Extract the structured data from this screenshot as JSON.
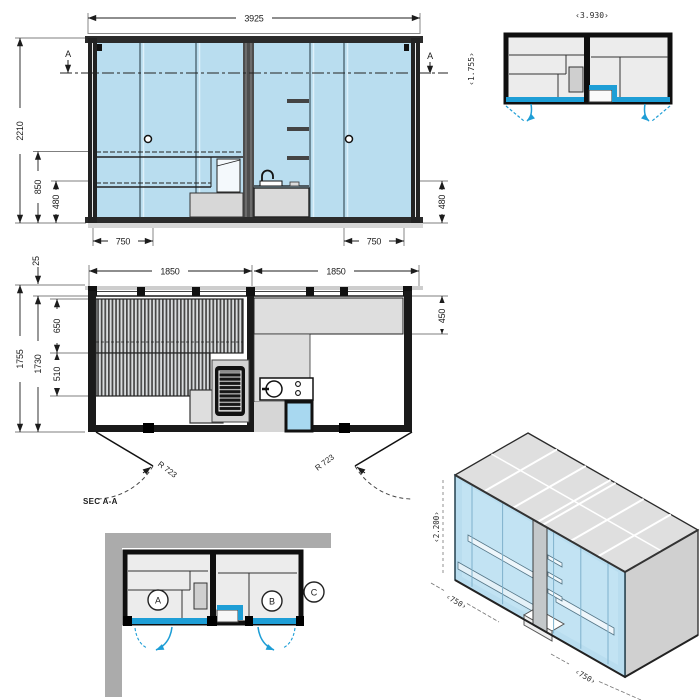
{
  "drawing": {
    "front_elevation": {
      "dim_width": "3925",
      "dim_height": "2210",
      "dim_bench_height": "850",
      "dim_seat_left": "480",
      "dim_seat_right": "480",
      "dim_door_left": "750",
      "dim_door_right": "750",
      "section_marker_left": "A",
      "section_marker_right": "A"
    },
    "floor_plan": {
      "dim_room_left": "1850",
      "dim_room_right": "1850",
      "dim_wall_thickness": "25",
      "dim_depth_outer": "1755",
      "dim_depth_inner": "1730",
      "dim_bench_upper": "650",
      "dim_bench_lower": "510",
      "dim_bench_right": "450",
      "door_radius_left": "R 723",
      "door_radius_right": "R 723",
      "section_label": "SEC A-A"
    },
    "overview_plan": {
      "dim_width": "‹3.930›",
      "dim_depth": "‹1.755›"
    },
    "placement_plan": {
      "room_a": "A",
      "room_b": "B",
      "room_c": "C"
    },
    "isometric": {
      "dim_height": "‹2.200›",
      "dim_door_left": "‹750›",
      "dim_door_right": "‹750›"
    },
    "colors": {
      "accent_blue": "#1e9ed6",
      "glass_blue": "#b9ddef",
      "panel_gray": "#dedede",
      "wall_gray": "#ababab",
      "line_dark": "#1a1a1a"
    }
  }
}
